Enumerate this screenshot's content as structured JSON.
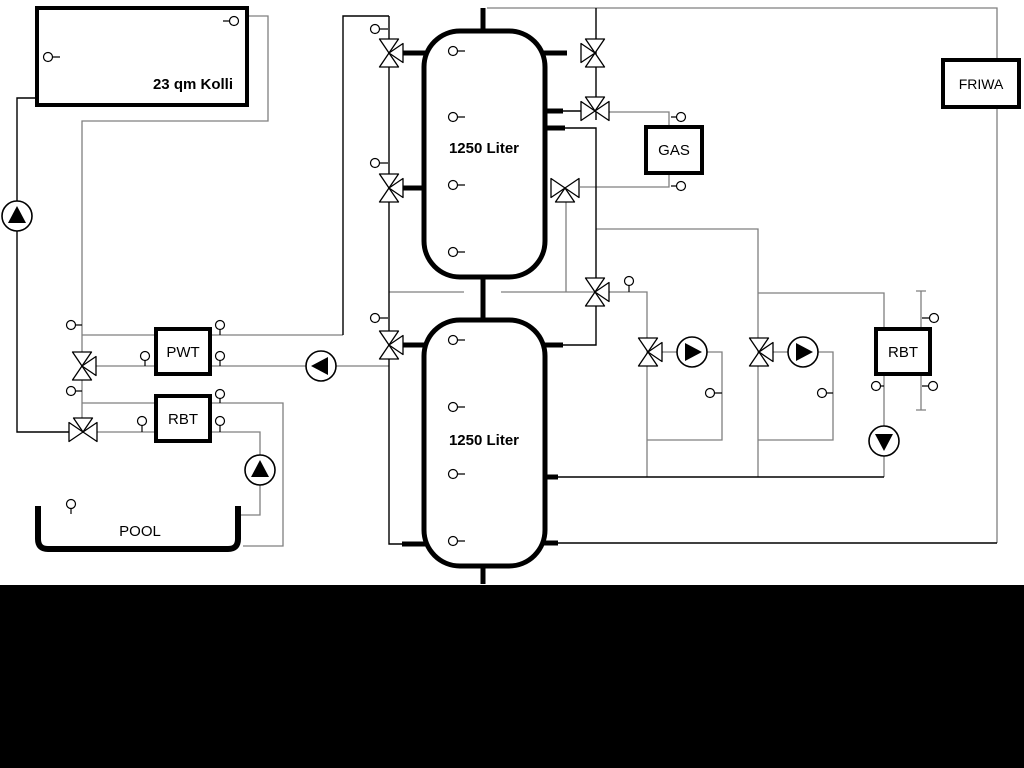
{
  "diagram": {
    "collector": {
      "label": "23 qm Kolli"
    },
    "tank_top": {
      "label": "1250 Liter"
    },
    "tank_bottom": {
      "label": "1250 Liter"
    },
    "pwt": {
      "label": "PWT"
    },
    "rbt_left": {
      "label": "RBT"
    },
    "rbt_right": {
      "label": "RBT"
    },
    "gas": {
      "label": "GAS"
    },
    "friwa": {
      "label": "FRIWA"
    },
    "pool": {
      "label": "POOL"
    }
  },
  "colors": {
    "line-black": "#000000",
    "line-gray": "#7f7f7f",
    "bg": "#ffffff",
    "band-black": "#000000"
  }
}
